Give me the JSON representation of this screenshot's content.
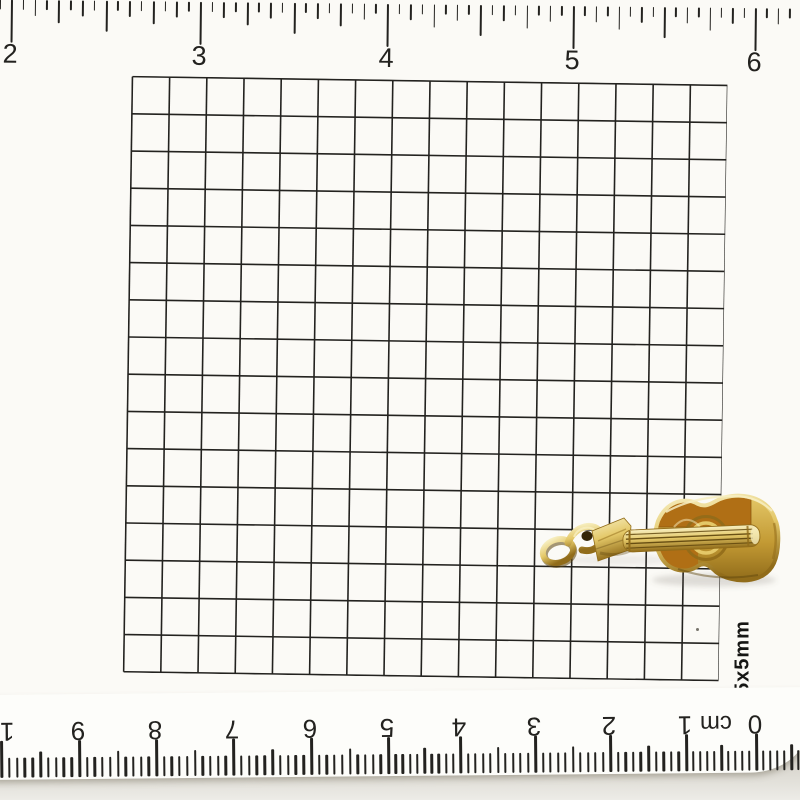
{
  "scene": {
    "description": "Gold guitar-shaped charm photographed on 5x5mm grid paper between an inch ruler (top) and an upside-down centimeter ruler (bottom)",
    "object_name": "gold guitar charm",
    "charm_parts": [
      "jump-ring",
      "bail",
      "headstock",
      "neck",
      "strings",
      "body",
      "sound-hole",
      "bridge-tip"
    ]
  },
  "colors": {
    "paper": "#fbfaf6",
    "ruler_white": "#fdfdfa",
    "ink": "#23221f",
    "gold_hi": "#f7efc2",
    "gold_light": "#e4c868",
    "gold_mid": "#c39a34",
    "gold_deep": "#916c1a",
    "gold_dark": "#5c430b",
    "amber": "#b06f15",
    "amber_dark": "#8a550e",
    "hole_dark": "#352608",
    "shadow": "#6b6456"
  },
  "top_ruler": {
    "subdivisions_per_unit": 16,
    "labels": [
      {
        "text": "2",
        "x": 19
      },
      {
        "text": "3",
        "x": 208
      },
      {
        "text": "4",
        "x": 395
      },
      {
        "text": "5",
        "x": 581
      },
      {
        "text": "6",
        "x": 763
      }
    ]
  },
  "bottom_ruler": {
    "orientation": "upside-down",
    "subdivisions_per_unit": 10,
    "unit_label": {
      "text": "cm",
      "x": 724
    },
    "labels": [
      {
        "text": "10",
        "x": 8
      },
      {
        "text": "9",
        "x": 86
      },
      {
        "text": "8",
        "x": 163
      },
      {
        "text": "7",
        "x": 240
      },
      {
        "text": "6",
        "x": 318
      },
      {
        "text": "5",
        "x": 395
      },
      {
        "text": "4",
        "x": 467
      },
      {
        "text": "3",
        "x": 542
      },
      {
        "text": "2",
        "x": 617
      },
      {
        "text": "1",
        "x": 693
      },
      {
        "text": "0",
        "x": 763
      }
    ]
  },
  "grid": {
    "label": "5x5mm",
    "columns": 16,
    "rows": 16,
    "cell_px": 37.2
  }
}
